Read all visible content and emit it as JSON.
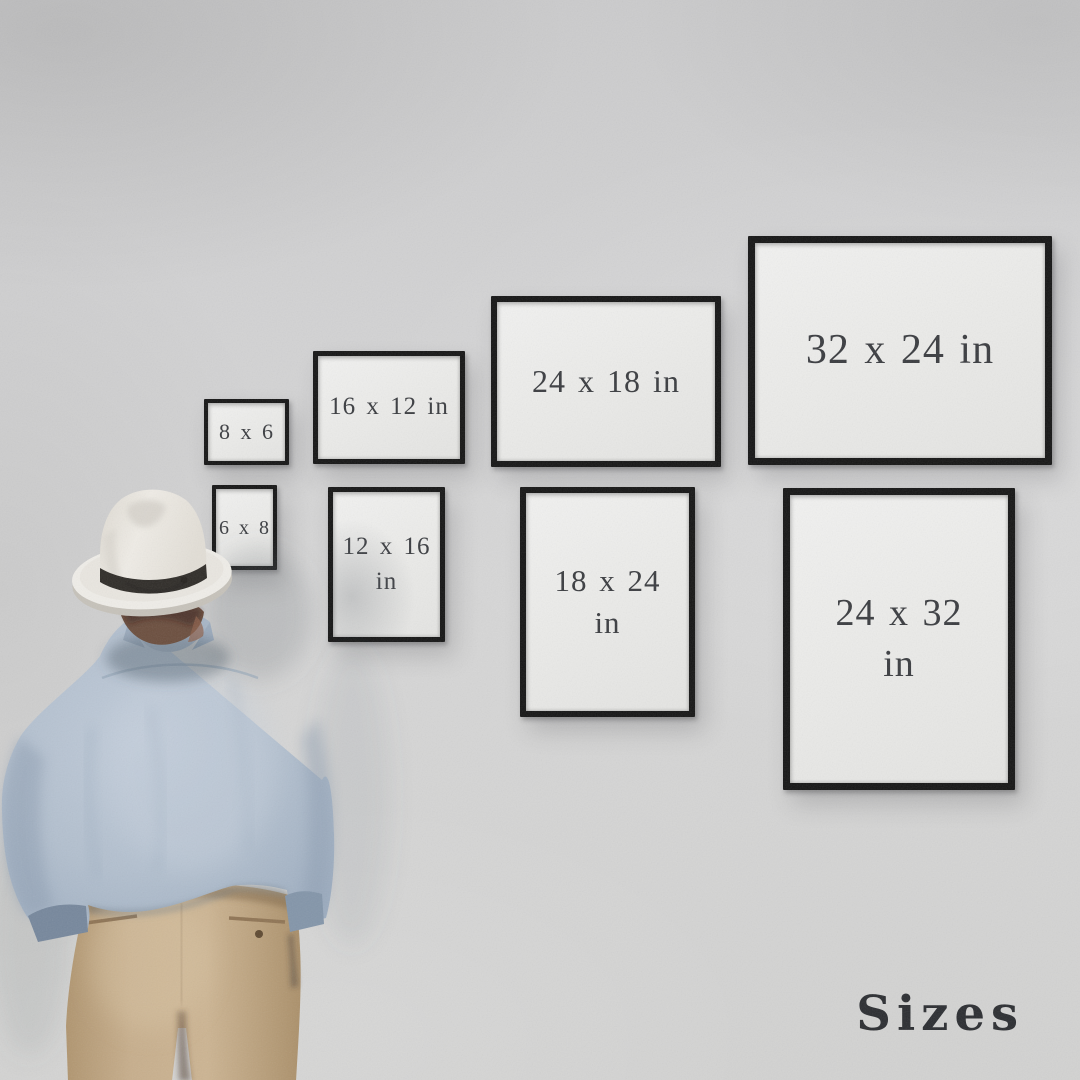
{
  "caption": "Sizes",
  "frames": [
    {
      "name": "8x6",
      "line1": "8 x 6",
      "line2": "",
      "orientation": "landscape"
    },
    {
      "name": "16x12",
      "line1": "16 x 12 in",
      "line2": "",
      "orientation": "landscape"
    },
    {
      "name": "24x18",
      "line1": "24 x 18 in",
      "line2": "",
      "orientation": "landscape"
    },
    {
      "name": "32x24",
      "line1": "32 x 24 in",
      "line2": "",
      "orientation": "landscape"
    },
    {
      "name": "6x8",
      "line1": "6 x 8",
      "line2": "",
      "orientation": "portrait"
    },
    {
      "name": "12x16",
      "line1": "12 x 16",
      "line2": "in",
      "orientation": "portrait"
    },
    {
      "name": "18x24",
      "line1": "18 x 24",
      "line2": "in",
      "orientation": "portrait"
    },
    {
      "name": "24x32",
      "line1": "24 x 32",
      "line2": "in",
      "orientation": "portrait"
    }
  ],
  "colors": {
    "wall": "#d2d2d3",
    "frame_border": "#151515",
    "frame_paper": "#ebebe9",
    "label_text": "#3a3c40",
    "caption_text": "#2b2d31",
    "hat": "#edeae4",
    "hat_band": "#2f2c28",
    "shirt": "#b4c0cf",
    "trousers": "#c4aa88",
    "hair": "#6b4e3e"
  }
}
